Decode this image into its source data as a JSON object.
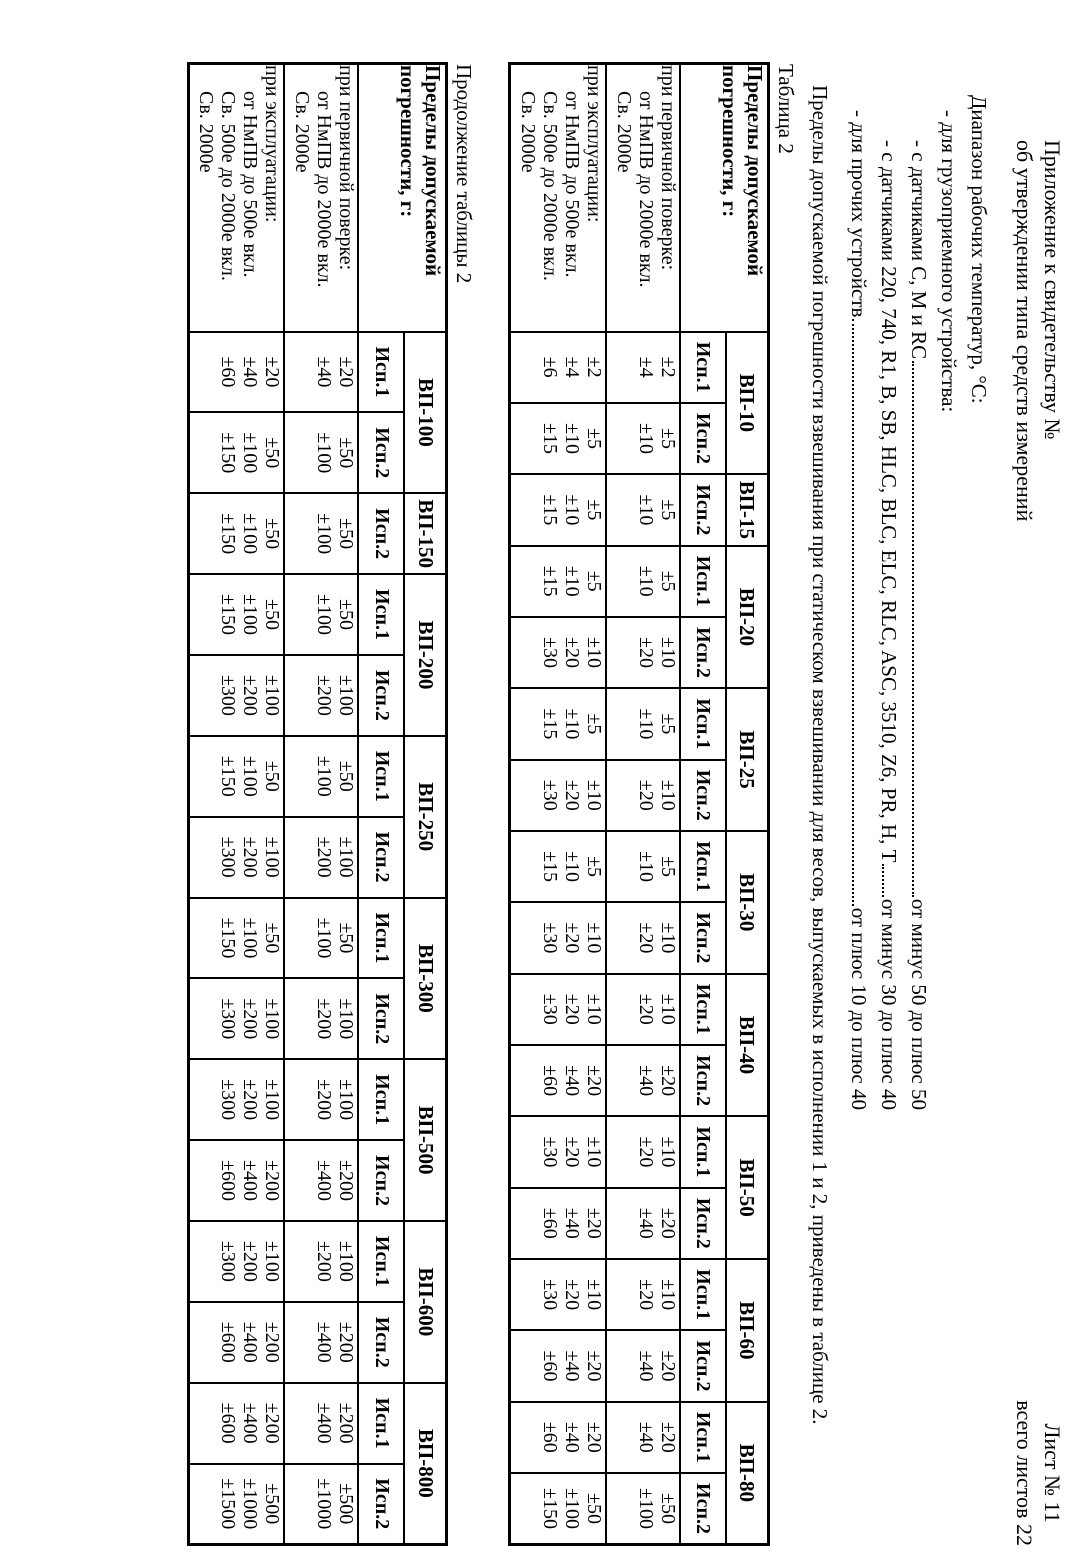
{
  "page_header": {
    "left": [
      "Приложение к свидетельству №",
      "об утверждении типа средств измерений"
    ],
    "right": [
      "Лист № 11",
      "всего листов 22"
    ]
  },
  "temperature_section": {
    "title": "Диапазон рабочих температур, °С:",
    "lines": [
      {
        "indent": 1,
        "text": "- для грузоприемного устройства:",
        "value": ""
      },
      {
        "indent": 2,
        "text": "- с датчиками С, М и RC",
        "value": "от минус 50 до плюс 50"
      },
      {
        "indent": 2,
        "text": "- с датчиками 220, 740, R1, B, SB, HLC, BLC, ELC, RLC, ASC, 3510, Z6, PR, H, Т",
        "value": "от минус 30 до плюс 40"
      },
      {
        "indent": 1,
        "text": "- для  прочих устройств",
        "value": "от плюс 10 до плюс 40"
      }
    ]
  },
  "paragraph": "Пределы допускаемой погрешности взвешивания при статическом взвешивании для весов, выпускаемых в исполнении 1 и 2, приведены в таблице 2.",
  "tables": [
    {
      "caption": "Таблица 2",
      "corner_lines": [
        "Пределы допускаемой",
        "погрешности, г:"
      ],
      "row_groups": [
        {
          "title": "при первичной поверке:",
          "rows": [
            "от НмПВ до 2000е вкл.",
            "Св. 2000е"
          ]
        },
        {
          "title": "при эксплуатации:",
          "rows": [
            "от НмПВ до 500е вкл.",
            "Св. 500е до 2000е вкл.",
            "Св. 2000е"
          ]
        }
      ],
      "models": [
        {
          "name": "ВП-10",
          "cols": [
            {
              "label": "Исп.1",
              "verify": [
                "±2",
                "±4"
              ],
              "operate": [
                "±2",
                "±4",
                "±6"
              ]
            },
            {
              "label": "Исп.2",
              "verify": [
                "±5",
                "±10"
              ],
              "operate": [
                "±5",
                "±10",
                "±15"
              ]
            }
          ]
        },
        {
          "name": "ВП-15",
          "cols": [
            {
              "label": "Исп.2",
              "verify": [
                "±5",
                "±10"
              ],
              "operate": [
                "±5",
                "±10",
                "±15"
              ]
            }
          ]
        },
        {
          "name": "ВП-20",
          "cols": [
            {
              "label": "Исп.1",
              "verify": [
                "±5",
                "±10"
              ],
              "operate": [
                "±5",
                "±10",
                "±15"
              ]
            },
            {
              "label": "Исп.2",
              "verify": [
                "±10",
                "±20"
              ],
              "operate": [
                "±10",
                "±20",
                "±30"
              ]
            }
          ]
        },
        {
          "name": "ВП-25",
          "cols": [
            {
              "label": "Исп.1",
              "verify": [
                "±5",
                "±10"
              ],
              "operate": [
                "±5",
                "±10",
                "±15"
              ]
            },
            {
              "label": "Исп.2",
              "verify": [
                "±10",
                "±20"
              ],
              "operate": [
                "±10",
                "±20",
                "±30"
              ]
            }
          ]
        },
        {
          "name": "ВП-30",
          "cols": [
            {
              "label": "Исп.1",
              "verify": [
                "±5",
                "±10"
              ],
              "operate": [
                "±5",
                "±10",
                "±15"
              ]
            },
            {
              "label": "Исп.2",
              "verify": [
                "±10",
                "±20"
              ],
              "operate": [
                "±10",
                "±20",
                "±30"
              ]
            }
          ]
        },
        {
          "name": "ВП-40",
          "cols": [
            {
              "label": "Исп.1",
              "verify": [
                "±10",
                "±20"
              ],
              "operate": [
                "±10",
                "±20",
                "±30"
              ]
            },
            {
              "label": "Исп.2",
              "verify": [
                "±20",
                "±40"
              ],
              "operate": [
                "±20",
                "±40",
                "±60"
              ]
            }
          ]
        },
        {
          "name": "ВП-50",
          "cols": [
            {
              "label": "Исп.1",
              "verify": [
                "±10",
                "±20"
              ],
              "operate": [
                "±10",
                "±20",
                "±30"
              ]
            },
            {
              "label": "Исп.2",
              "verify": [
                "±20",
                "±40"
              ],
              "operate": [
                "±20",
                "±40",
                "±60"
              ]
            }
          ]
        },
        {
          "name": "ВП-60",
          "cols": [
            {
              "label": "Исп.1",
              "verify": [
                "±10",
                "±20"
              ],
              "operate": [
                "±10",
                "±20",
                "±30"
              ]
            },
            {
              "label": "Исп.2",
              "verify": [
                "±20",
                "±40"
              ],
              "operate": [
                "±20",
                "±40",
                "±60"
              ]
            }
          ]
        },
        {
          "name": "ВП-80",
          "cols": [
            {
              "label": "Исп.1",
              "verify": [
                "±20",
                "±40"
              ],
              "operate": [
                "±20",
                "±40",
                "±60"
              ]
            },
            {
              "label": "Исп.2",
              "verify": [
                "±50",
                "±100"
              ],
              "operate": [
                "±50",
                "±100",
                "±150"
              ]
            }
          ]
        }
      ]
    },
    {
      "caption": "Продолжение таблицы 2",
      "corner_lines": [
        "Пределы допускаемой",
        "погрешности, г:"
      ],
      "row_groups": [
        {
          "title": "при первичной поверке:",
          "rows": [
            "от НмПВ до 2000е вкл.",
            "Св. 2000е"
          ]
        },
        {
          "title": "при эксплуатации:",
          "rows": [
            "от НмПВ до 500е вкл.",
            "Св. 500е до 2000е вкл.",
            "Св. 2000е"
          ]
        }
      ],
      "models": [
        {
          "name": "ВП-100",
          "cols": [
            {
              "label": "Исп.1",
              "verify": [
                "±20",
                "±40"
              ],
              "operate": [
                "±20",
                "±40",
                "±60"
              ]
            },
            {
              "label": "Исп.2",
              "verify": [
                "±50",
                "±100"
              ],
              "operate": [
                "±50",
                "±100",
                "±150"
              ]
            }
          ]
        },
        {
          "name": "ВП-150",
          "cols": [
            {
              "label": "Исп.2",
              "verify": [
                "±50",
                "±100"
              ],
              "operate": [
                "±50",
                "±100",
                "±150"
              ]
            }
          ]
        },
        {
          "name": "ВП-200",
          "cols": [
            {
              "label": "Исп.1",
              "verify": [
                "±50",
                "±100"
              ],
              "operate": [
                "±50",
                "±100",
                "±150"
              ]
            },
            {
              "label": "Исп.2",
              "verify": [
                "±100",
                "±200"
              ],
              "operate": [
                "±100",
                "±200",
                "±300"
              ]
            }
          ]
        },
        {
          "name": "ВП-250",
          "cols": [
            {
              "label": "Исп.1",
              "verify": [
                "±50",
                "±100"
              ],
              "operate": [
                "±50",
                "±100",
                "±150"
              ]
            },
            {
              "label": "Исп.2",
              "verify": [
                "±100",
                "±200"
              ],
              "operate": [
                "±100",
                "±200",
                "±300"
              ]
            }
          ]
        },
        {
          "name": "ВП-300",
          "cols": [
            {
              "label": "Исп.1",
              "verify": [
                "±50",
                "±100"
              ],
              "operate": [
                "±50",
                "±100",
                "±150"
              ]
            },
            {
              "label": "Исп.2",
              "verify": [
                "±100",
                "±200"
              ],
              "operate": [
                "±100",
                "±200",
                "±300"
              ]
            }
          ]
        },
        {
          "name": "ВП-500",
          "cols": [
            {
              "label": "Исп.1",
              "verify": [
                "±100",
                "±200"
              ],
              "operate": [
                "±100",
                "±200",
                "±300"
              ]
            },
            {
              "label": "Исп.2",
              "verify": [
                "±200",
                "±400"
              ],
              "operate": [
                "±200",
                "±400",
                "±600"
              ]
            }
          ]
        },
        {
          "name": "ВП-600",
          "cols": [
            {
              "label": "Исп.1",
              "verify": [
                "±100",
                "±200"
              ],
              "operate": [
                "±100",
                "±200",
                "±300"
              ]
            },
            {
              "label": "Исп.2",
              "verify": [
                "±200",
                "±400"
              ],
              "operate": [
                "±200",
                "±400",
                "±600"
              ]
            }
          ]
        },
        {
          "name": "ВП-800",
          "cols": [
            {
              "label": "Исп.1",
              "verify": [
                "±200",
                "±400"
              ],
              "operate": [
                "±200",
                "±400",
                "±600"
              ]
            },
            {
              "label": "Исп.2",
              "verify": [
                "±500",
                "±1000"
              ],
              "operate": [
                "±500",
                "±1000",
                "±1500"
              ]
            }
          ]
        }
      ]
    }
  ]
}
